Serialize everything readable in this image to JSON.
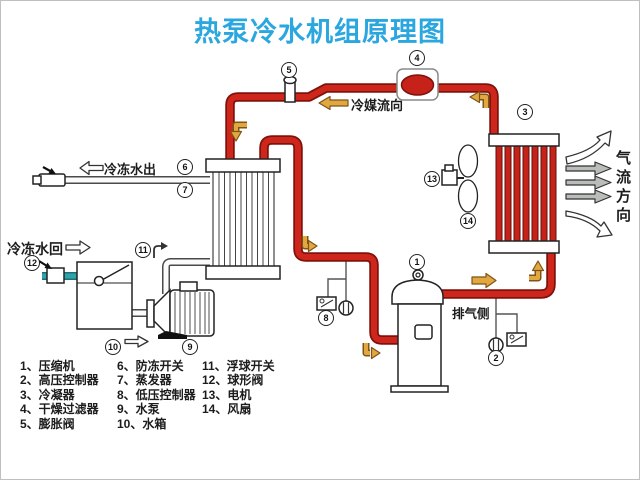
{
  "title": "热泵冷水机组原理图",
  "labels": {
    "refrigerant_flow": "冷媒流向",
    "chilled_water_out": "冷冻水出",
    "chilled_water_return": "冷冻水回",
    "exhaust_side": "排气侧",
    "airflow_direction": "气流方向"
  },
  "markers": {
    "m1": "1",
    "m2": "2",
    "m3": "3",
    "m4": "4",
    "m5": "5",
    "m6": "6",
    "m7": "7",
    "m8": "8",
    "m9": "9",
    "m10": "10",
    "m11": "11",
    "m12": "12",
    "m13": "13",
    "m14": "14"
  },
  "legend": {
    "col1": [
      "1、压缩机",
      "2、高压控制器",
      "3、冷凝器",
      "4、干燥过滤器",
      "5、膨胀阀"
    ],
    "col2": [
      "6、防冻开关",
      "7、蒸发器",
      "8、低压控制器",
      "9、水泵",
      "10、水箱"
    ],
    "col3": [
      "11、浮球开关",
      "12、球形阀",
      "13、电机",
      "14、风扇"
    ]
  },
  "colors": {
    "title_blue": "#2AA7DF",
    "pipe_red": "#CE261A",
    "pipe_red_outline": "#7E120C",
    "arrow_amber": "#E2A73F",
    "water_return_teal": "#2FA3AC"
  }
}
